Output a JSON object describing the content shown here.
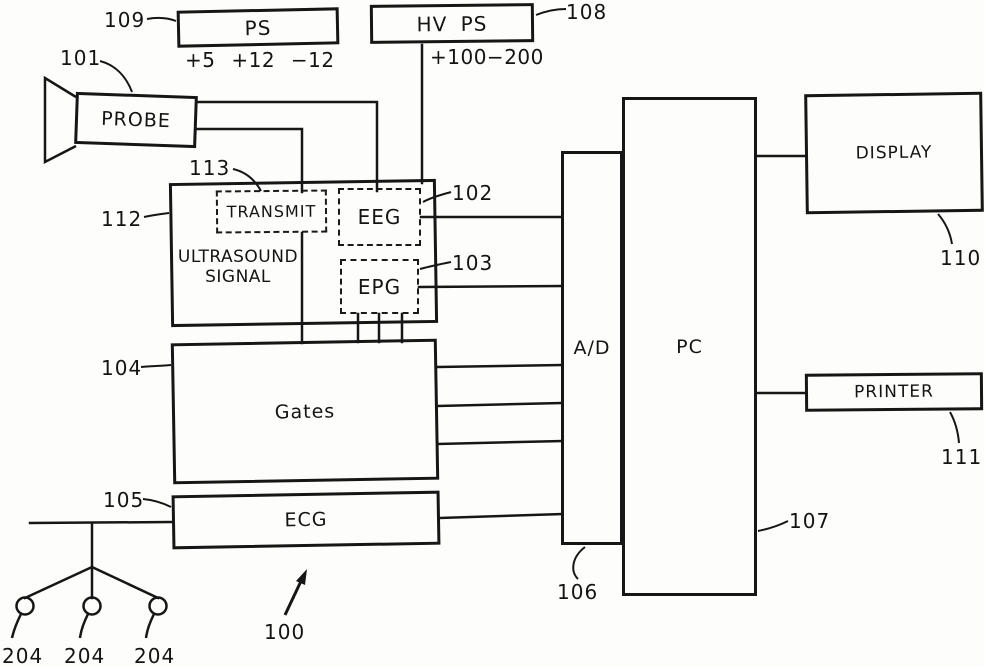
{
  "figure": {
    "system_ref": "100",
    "electrode_ref": "204",
    "boxes": {
      "ps": {
        "label": "PS",
        "ref": "109",
        "voltages": "+5 +12 −12"
      },
      "hv_ps": {
        "label": "HV PS",
        "ref": "108",
        "voltages": "+100−200"
      },
      "probe": {
        "label": "PROBE",
        "ref": "101"
      },
      "ultrasound_signal": {
        "line1": "ULTRASOUND",
        "line2": "SIGNAL",
        "ref": "112"
      },
      "transmit": {
        "label": "TRANSMIT",
        "ref": "113"
      },
      "eeg": {
        "label": "EEG",
        "ref": "102"
      },
      "epg": {
        "label": "EPG",
        "ref": "103"
      },
      "gates": {
        "label": "Gates",
        "ref": "104"
      },
      "ecg": {
        "label": "ECG",
        "ref": "105"
      },
      "ad_converter": {
        "label": "A/D",
        "ref": "106"
      },
      "pc": {
        "label": "PC",
        "ref": "107"
      },
      "display": {
        "label": "DISPLAY",
        "ref": "110"
      },
      "printer": {
        "label": "PRINTER",
        "ref": "111"
      }
    }
  }
}
